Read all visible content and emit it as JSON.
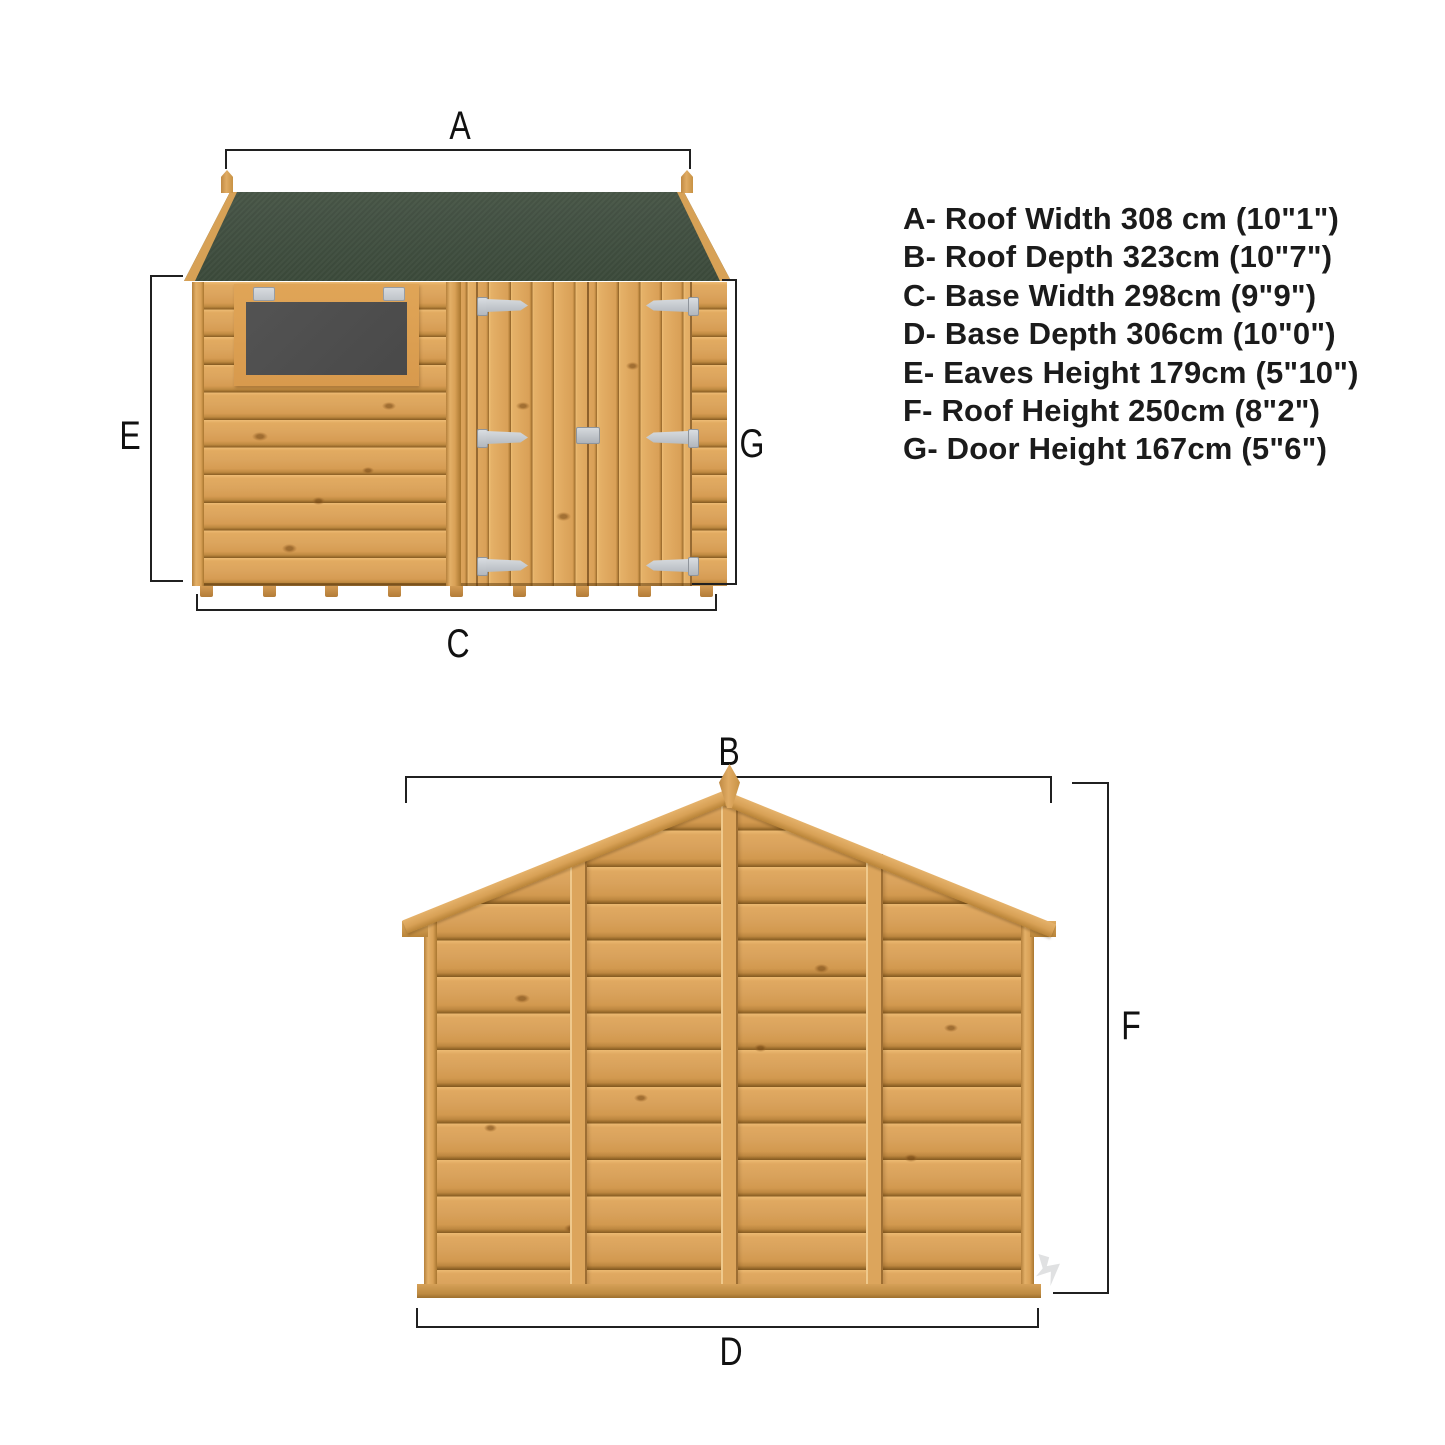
{
  "legend": {
    "items": [
      {
        "letter": "A",
        "name": "Roof Width",
        "cm": "308 cm",
        "imperial": "10\"1\"",
        "text": "A- Roof Width 308 cm (10\"1\")"
      },
      {
        "letter": "B",
        "name": "Roof Depth",
        "cm": "323cm",
        "imperial": "10\"7\"",
        "text": "B- Roof Depth 323cm (10\"7\")"
      },
      {
        "letter": "C",
        "name": "Base Width",
        "cm": "298cm",
        "imperial": "9\"9\"",
        "text": "C- Base Width 298cm (9\"9\")"
      },
      {
        "letter": "D",
        "name": "Base Depth",
        "cm": "306cm",
        "imperial": "10\"0\"",
        "text": "D- Base Depth 306cm (10\"0\")"
      },
      {
        "letter": "E",
        "name": "Eaves Height",
        "cm": "179cm",
        "imperial": "5\"10\"",
        "text": "E- Eaves Height 179cm (5\"10\")"
      },
      {
        "letter": "F",
        "name": "Roof Height",
        "cm": "250cm",
        "imperial": "8\"2\"",
        "text": "F- Roof Height 250cm (8\"2\")"
      },
      {
        "letter": "G",
        "name": "Door Height",
        "cm": "167cm",
        "imperial": "5\"6\"",
        "text": "G- Door Height 167cm (5\"6\")"
      }
    ]
  },
  "dims": {
    "a": "A",
    "b": "B",
    "c": "C",
    "d": "D",
    "e": "E",
    "f": "F",
    "g": "G"
  },
  "colors": {
    "background": "#ffffff",
    "roof_felt_green": "#45523f",
    "wood_tan": "#dca55e",
    "wood_seam_dark": "#845a21",
    "window_pane_gray": "#4e4e4e",
    "hardware_gray": "#ccd0d4",
    "dimension_line": "#202020"
  }
}
